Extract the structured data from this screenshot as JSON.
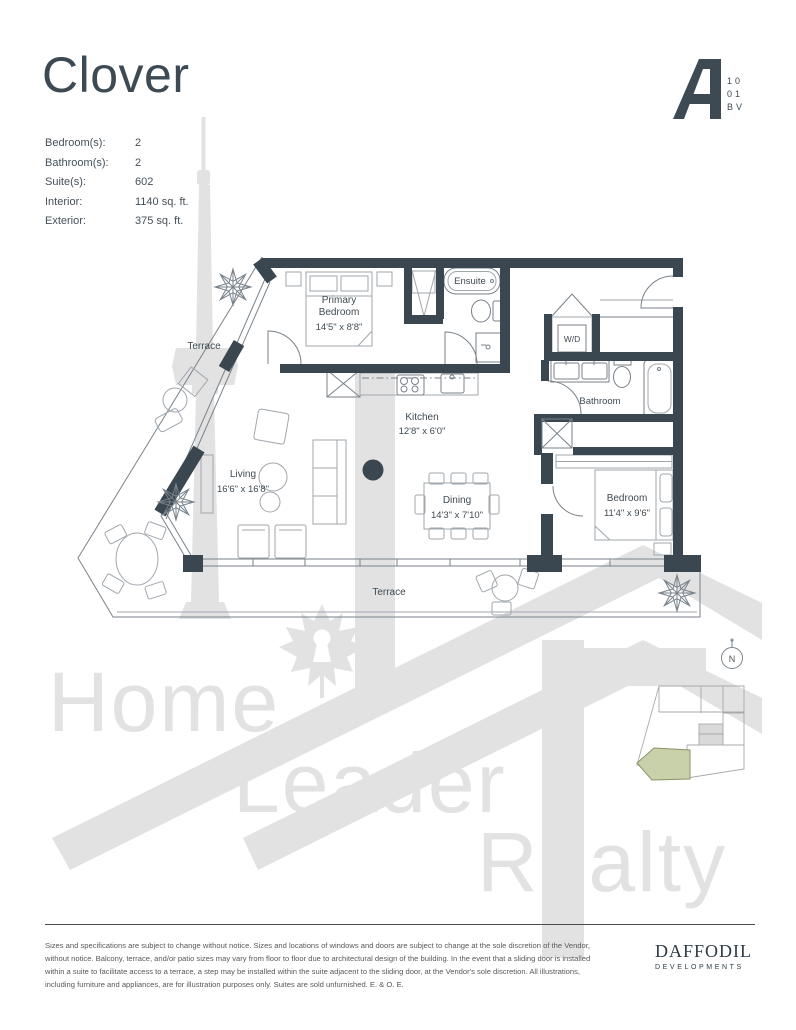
{
  "colors": {
    "ink": "#3d4a54",
    "wall": "#3b4750",
    "plan_line": "#78828b",
    "watermark": "#e2e2e2",
    "keyplan_highlight": "#c9d1ab"
  },
  "header": {
    "title": "Clover",
    "suite_logo": {
      "letter": "A",
      "unit_lines": [
        "10",
        "01",
        "BV"
      ]
    }
  },
  "specs": {
    "rows": [
      {
        "label": "Bedroom(s):",
        "value": "2"
      },
      {
        "label": "Bathroom(s):",
        "value": "2"
      },
      {
        "label": "Suite(s):",
        "value": "602"
      },
      {
        "label": "Interior:",
        "value": "1140 sq. ft."
      },
      {
        "label": "Exterior:",
        "value": "375 sq. ft."
      }
    ]
  },
  "floorplan": {
    "rooms": {
      "primary_bedroom": {
        "name_line1": "Primary",
        "name_line2": "Bedroom",
        "dims": "14'5\" x 8'8\""
      },
      "ensuite": {
        "name": "Ensuite"
      },
      "laundry": {
        "name": "W/D"
      },
      "bathroom": {
        "name": "Bathroom"
      },
      "kitchen": {
        "name": "Kitchen",
        "dims": "12'8\" x 6'0\""
      },
      "living": {
        "name": "Living",
        "dims": "16'6\" x 16'8\""
      },
      "dining": {
        "name": "Dining",
        "dims": "14'3\" x 7'10\""
      },
      "bedroom": {
        "name": "Bedroom",
        "dims": "11'4\" x 9'6\""
      },
      "terrace_upper": {
        "name": "Terrace"
      },
      "terrace_lower": {
        "name": "Terrace"
      }
    },
    "compass": {
      "label": "N"
    }
  },
  "watermark": {
    "words": [
      "Home",
      "Leader",
      "Realty"
    ]
  },
  "footer": {
    "disclaimer": "Sizes and specifications are subject to change without notice. Sizes and locations of windows and doors are subject to change at the sole discretion of the Vendor,\nwithout notice. Balcony, terrace, and/or patio sizes may vary from floor to floor due to architectural design of the building. In the event that a sliding door is installed\nwithin a suite to facilitate access to a terrace, a step may be installed within the suite adjacent to the sliding door, at the Vendor's sole discretion. All illustrations,\nincluding furniture and appliances, are for illustration purposes only. Suites are sold unfurnished. E. & O. E.",
    "brand": {
      "name": "DAFFODIL",
      "subtitle": "DEVELOPMENTS"
    }
  }
}
